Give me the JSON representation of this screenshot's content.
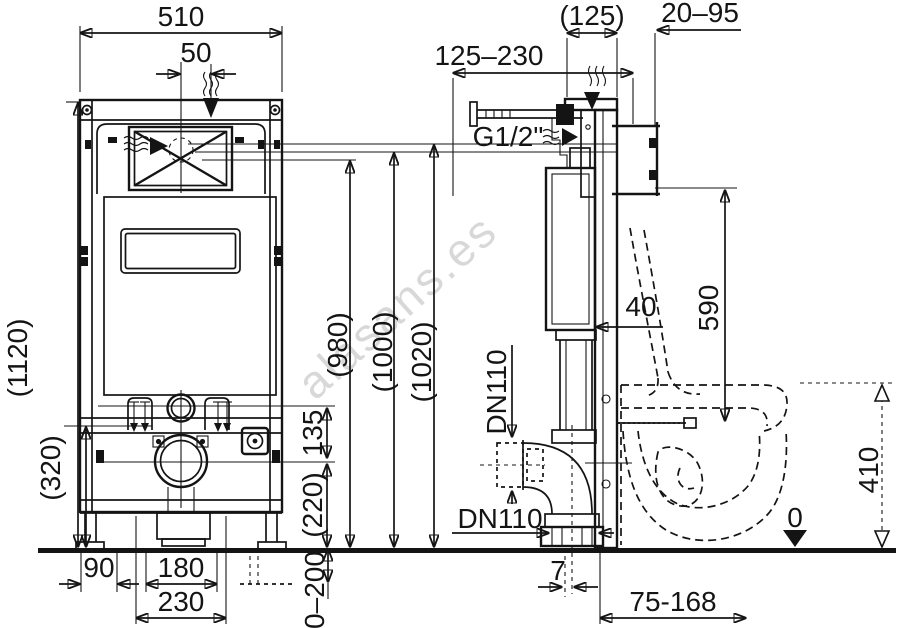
{
  "watermark": "alasans.es",
  "drawing": {
    "brand": "RAVAK",
    "brand_reg": "®",
    "front_view": {
      "width": "510",
      "flush_offset": "50",
      "total_height": "(1120)",
      "lower_frame_height": "(320)",
      "foot_offset": "90",
      "stud_spacing_inner": "180",
      "stud_spacing_outer": "230",
      "foot_adjust_range": "0–200",
      "inlet_outlet_gap": "135",
      "outlet_height": "(220)"
    },
    "install_heights": {
      "h1": "(980)",
      "h2": "(1000)",
      "h3": "(1020)"
    },
    "side_view": {
      "top_depth": "(125)",
      "wall_distance": "20–95",
      "inlet_position_range": "125–230",
      "water_connection": "G1/2\"",
      "frame_offset": "40",
      "bracket_to_stud": "590",
      "drain_vertical": "DN110",
      "drain_horizontal": "DN110",
      "outlet_axis_offset": "7",
      "outlet_distance_range": "75-168",
      "bowl_rim_height": "410",
      "floor_level": "0"
    }
  }
}
